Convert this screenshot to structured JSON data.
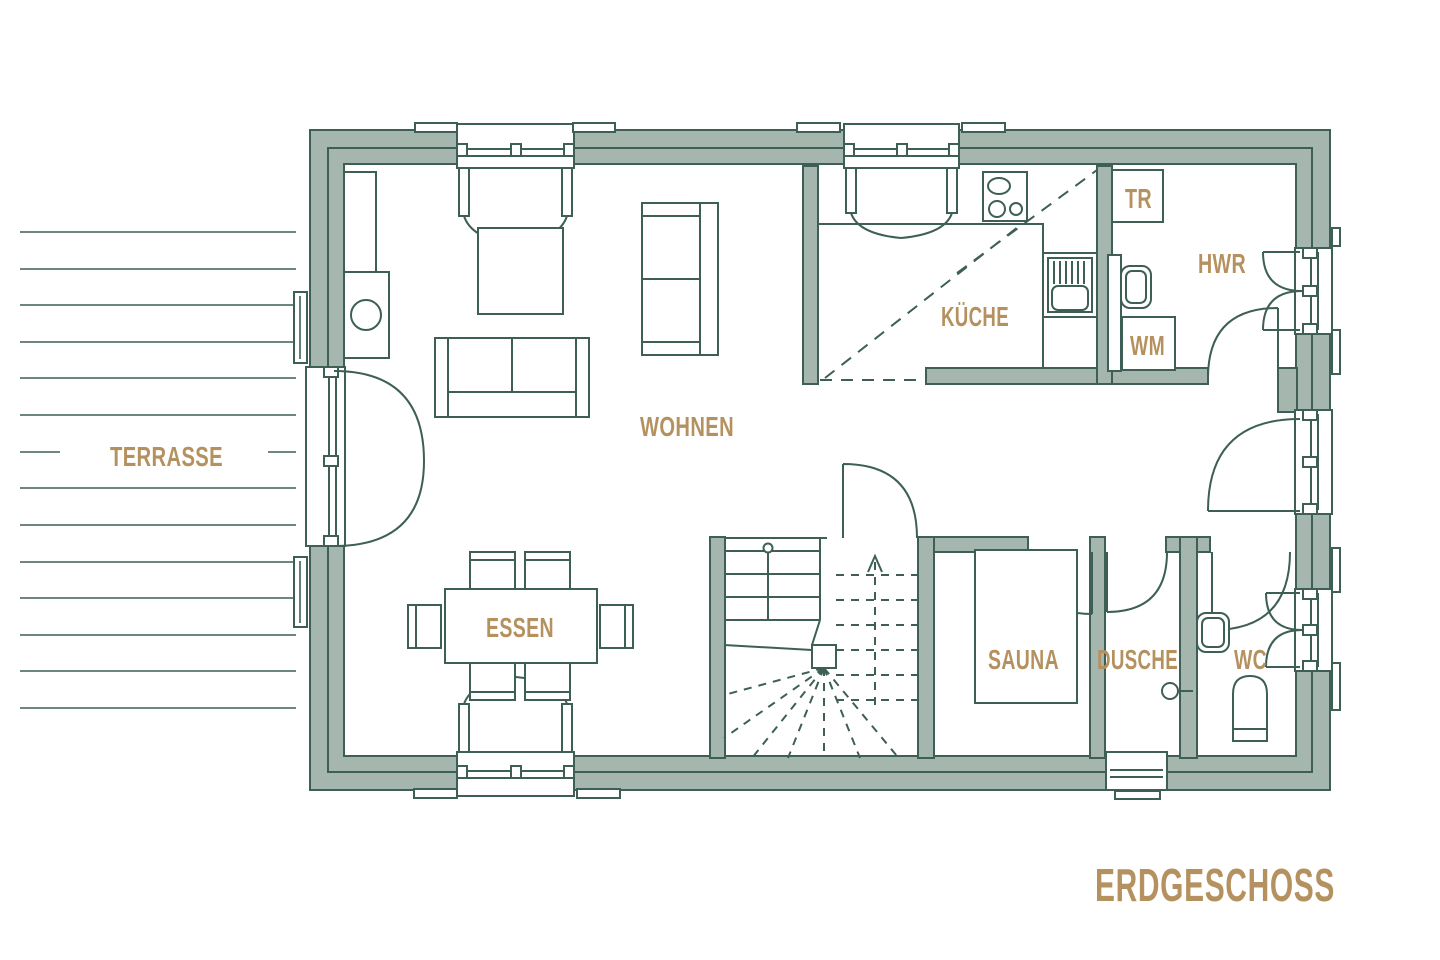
{
  "plan_title": "ERDGESCHOSS",
  "colors": {
    "wall_fill": "#a4b6ae",
    "outline": "#3d5f55",
    "label": "#b5915f",
    "background": "#ffffff"
  },
  "rooms": {
    "terrasse": "TERRASSE",
    "wohnen": "WOHNEN",
    "essen": "ESSEN",
    "kueche": "KÜCHE",
    "hwr": "HWR",
    "sauna": "SAUNA",
    "dusche": "DUSCHE",
    "wc": "WC"
  },
  "appliances": {
    "tr": "TR",
    "wm": "WM"
  }
}
